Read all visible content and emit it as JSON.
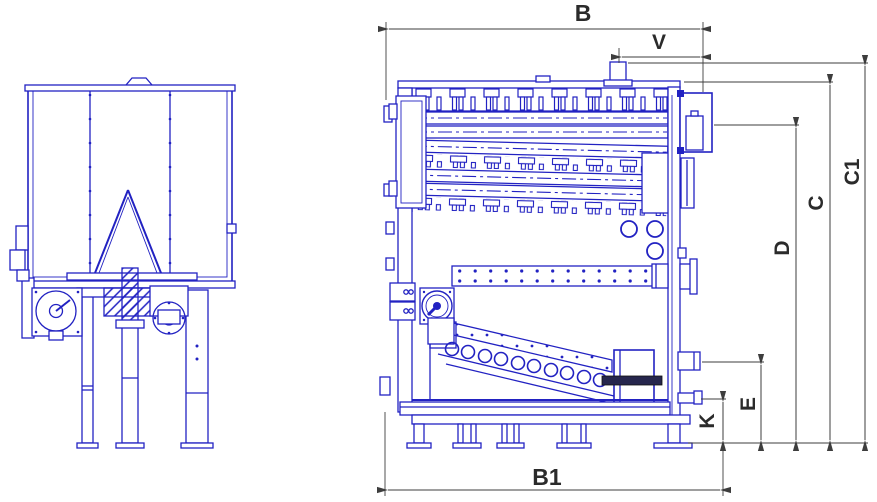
{
  "drawing": {
    "labels": {
      "b": "B",
      "v": "V",
      "c1": "C1",
      "c": "C",
      "d": "D",
      "e": "E",
      "k": "K",
      "b1": "B1"
    },
    "colors": {
      "blueprint": "#2222c2",
      "dimension": "#3d3d3d",
      "label_text": "#2b2b2b",
      "background": "#ffffff",
      "crusher_bar": "#26264d"
    }
  }
}
